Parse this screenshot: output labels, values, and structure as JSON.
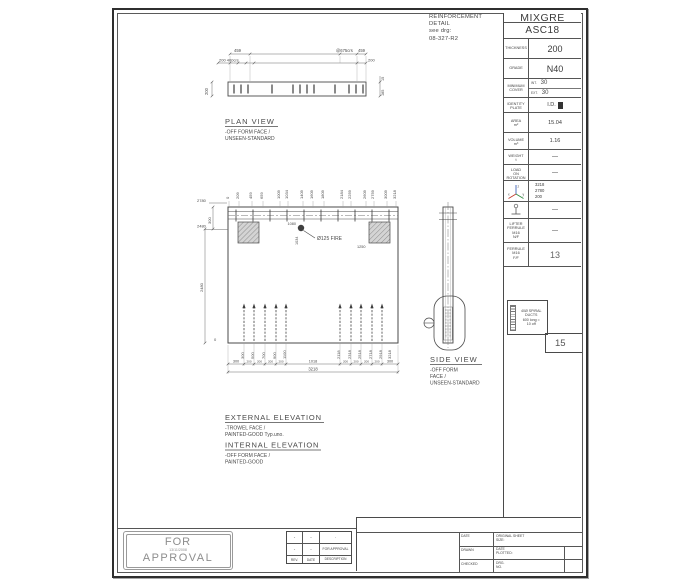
{
  "note_block": {
    "l1": "REINFORCEMENT",
    "l2": "DETAIL",
    "l3": "see drg:",
    "l4": "08-327-R2"
  },
  "info": {
    "title": "MIXGRE",
    "subtitle": "ASC18",
    "thickness_label": "THICKNESS",
    "thickness": "200",
    "grade_label": "GRADE",
    "grade": "N40",
    "cover_label1": "MINIMUM",
    "cover_label2": "COVER",
    "int_label": "INT.",
    "int_value": "30",
    "ext_label": "EXT.",
    "ext_value": "30",
    "identity_label1": "IDENTITY",
    "identity_label2": "PLATE",
    "identity_value": "I.D.",
    "area_label1": "AREA",
    "area_label2": "m²",
    "area": "15.04",
    "volume_label1": "VOLUME",
    "volume_label2": "m³",
    "volume": "1.16",
    "weight_label1": "WEIGHT",
    "weight_label2": "t",
    "weight": "—",
    "load_label1": "LOAD",
    "load_label2": "ON",
    "load_label3": "ROTATION",
    "load": "—",
    "axis": {
      "x_letter": "x",
      "y_letter": "y",
      "z_letter": "z",
      "x": "3218",
      "y": "2780",
      "z": "200"
    },
    "lifter_value": "—",
    "ferrule_nf_l1": "LIFTER",
    "ferrule_nf_l2": "FERRULE",
    "ferrule_nf_l3": "M16",
    "ferrule_nf_l4": "N/F",
    "ferrule_nf": "—",
    "ferrule_ff_l1": "FERRULE",
    "ferrule_ff_l2": "M16",
    "ferrule_ff_l3": "F/F",
    "ferrule_ff": "13",
    "duct_l1": "40Ø SPIRAL",
    "duct_l2": "DUCTS",
    "duct_l3": "600 long =",
    "duct_l4": "10 off",
    "duct_count": "15"
  },
  "plan": {
    "title": "PLAN VIEW",
    "sub1": "-OFF FORM FACE /",
    "sub2": "UNSEEN-STANDARD",
    "d459l": "459",
    "d200_400": "200 400crs",
    "d675": "@675crs",
    "d459r": "459",
    "d200r": "200",
    "d200side": "200",
    "d15": "15",
    "d185": "185"
  },
  "elevation": {
    "top_dims": [
      "0",
      "209",
      "459",
      "659",
      "1009",
      "1034",
      "1409",
      "1609",
      "1809",
      "2184",
      "2259",
      "2609",
      "2759",
      "3009",
      "3218"
    ],
    "d2780": "2780",
    "d300": "300",
    "d2480a": "2480",
    "d2480b": "2480",
    "d0": "0",
    "fire_note": "Ø125 FIRE",
    "fire_x": "1080",
    "fire_y": "1034",
    "d1250": "1250",
    "bars_left": [
      "300",
      "500",
      "700",
      "900",
      "1100"
    ],
    "bars_right": [
      "2118",
      "2318",
      "2518",
      "2718",
      "2918"
    ],
    "bar_end": "3218",
    "bottom_dims": [
      "300",
      "200",
      "200",
      "200",
      "200",
      "1018",
      "200",
      "200",
      "200",
      "200",
      "300"
    ],
    "total": "3218"
  },
  "side": {
    "title": "SIDE VIEW",
    "sub1": "-OFF FORM",
    "sub2": "FACE /",
    "sub3": "UNSEEN-STANDARD"
  },
  "notes": {
    "external_title": "EXTERNAL ELEVATION",
    "external_sub1": "-TROWEL FACE /",
    "external_sub2": "PAINTED-GOOD Typ.uno.",
    "internal_title": "INTERNAL ELEVATION",
    "internal_sub1": "-OFF FORM FACE /",
    "internal_sub2": "PAINTED-GOOD"
  },
  "stamp": {
    "line1": "FOR",
    "date": "13/11/2008",
    "line2": "APPROVAL"
  },
  "rev": {
    "headers": [
      "REV.",
      "DATE",
      "DESCRIPTION"
    ],
    "rows": [
      [
        "-",
        "-",
        "-"
      ],
      [
        "-",
        "-",
        "FOR APPROVAL"
      ]
    ]
  },
  "tb": {
    "date_label": "DATE",
    "drawn_label": "DRAWN",
    "checked_label": "CHECKED",
    "sheet_size_l1": "ORIGINAL SHEET",
    "sheet_size_l2": "SIZE:",
    "plotted_l1": "DATE",
    "plotted_l2": "PLOTTED:",
    "drg_l1": "DRG.",
    "drg_l2": "NO."
  }
}
